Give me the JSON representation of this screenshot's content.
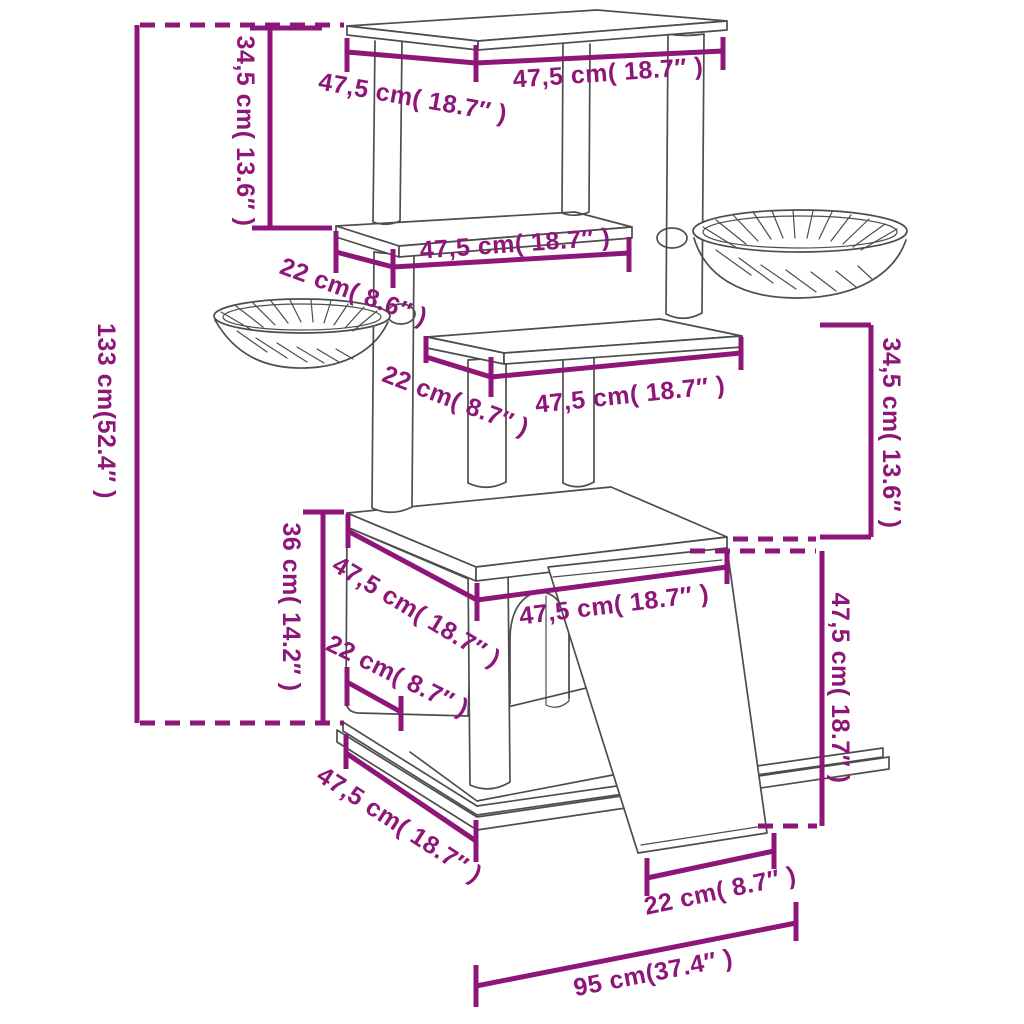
{
  "diagram": {
    "type": "product-dimension-diagram",
    "subject": "cat-tree-with-scratching-posts-baskets-house-and-ramp",
    "units": [
      "cm",
      "inch"
    ],
    "colors": {
      "dimension_annotation": "#8E1679",
      "line_art": "#4d4d4d",
      "background": "#ffffff"
    },
    "annotations": [
      {
        "id": "top-platform-depth",
        "text": "47,5 cm( 18.7″ )"
      },
      {
        "id": "top-platform-width",
        "text": "47,5 cm( 18.7″ )"
      },
      {
        "id": "upper-section-height",
        "text": "34,5 cm( 13.6″ )"
      },
      {
        "id": "total-height",
        "text": "133 cm(52.4″ )"
      },
      {
        "id": "middle-shelf-width",
        "text": "47,5 cm( 18.7″ )"
      },
      {
        "id": "middle-shelf-depth",
        "text": "22 cm( 8.6″ )"
      },
      {
        "id": "lower-shelf-depth",
        "text": "22 cm( 8.7″ )"
      },
      {
        "id": "lower-shelf-width",
        "text": "47,5 cm( 18.7″ )"
      },
      {
        "id": "mid-section-height",
        "text": "34,5 cm( 13.6″ )"
      },
      {
        "id": "house-roof-width",
        "text": "47,5 cm( 18.7″ )"
      },
      {
        "id": "house-roof-depth",
        "text": "47,5 cm( 18.7″ )"
      },
      {
        "id": "house-height",
        "text": "36 cm( 14.2″ )"
      },
      {
        "id": "base-front-lip",
        "text": "22 cm( 8.7″ )"
      },
      {
        "id": "ramp-height",
        "text": "47,5 cm( 18.7″ )"
      },
      {
        "id": "base-depth",
        "text": "47,5 cm( 18.7″ )"
      },
      {
        "id": "ramp-bottom-width",
        "text": "22 cm( 8.7″ )"
      },
      {
        "id": "footprint-width",
        "text": "95 cm(37.4″ )"
      }
    ]
  }
}
